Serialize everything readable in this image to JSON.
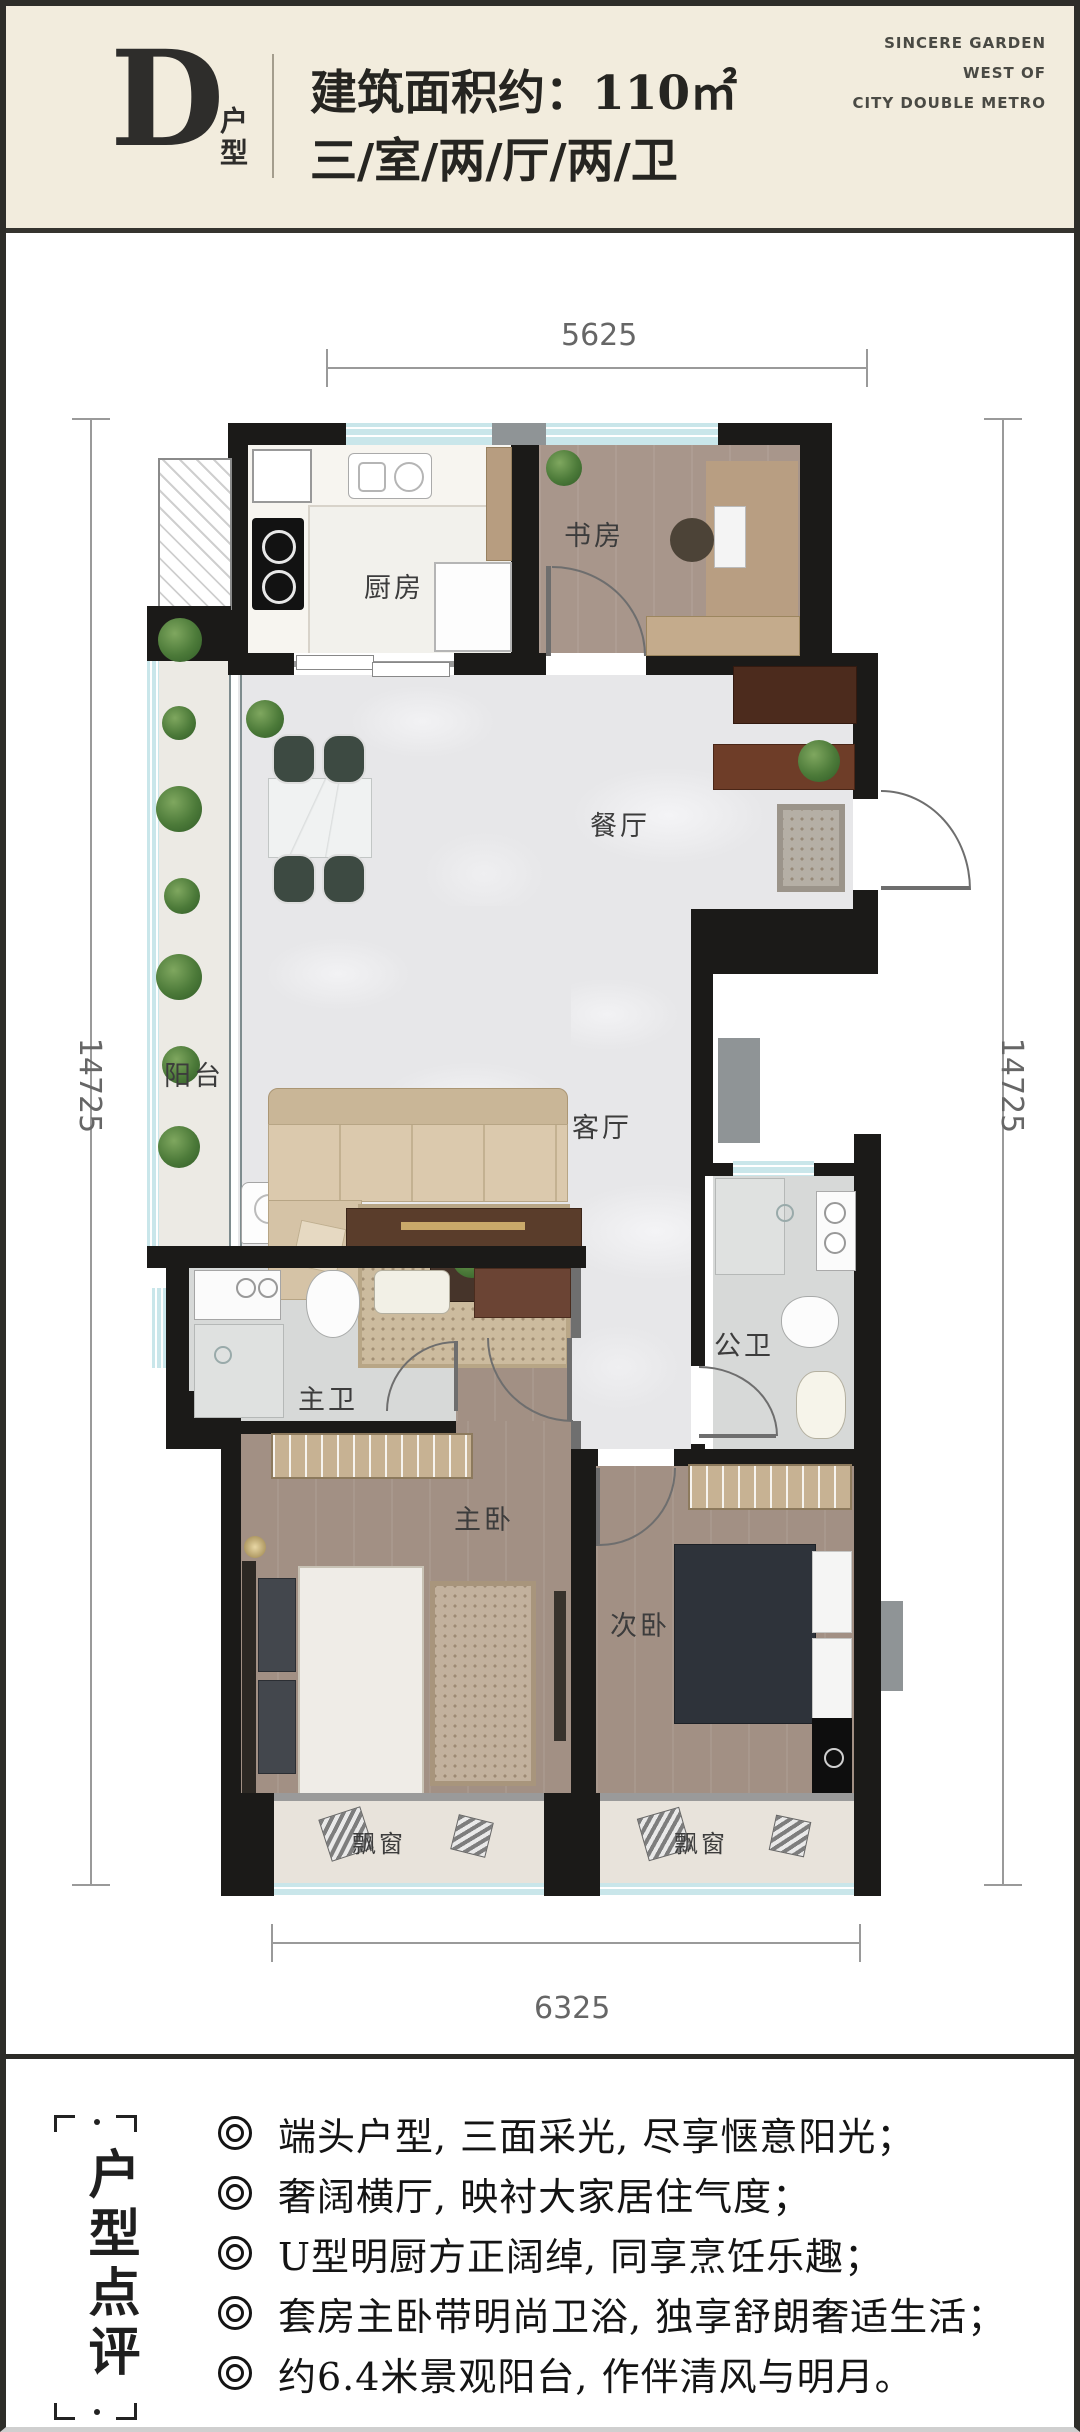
{
  "header": {
    "unit_letter": "D",
    "unit_label": "户型",
    "area_line": "建筑面积约：110㎡",
    "layout_line": "三/室/两/厅/两/卫",
    "brand_line1": "SINCERE GARDEN",
    "brand_line2": "WEST OF",
    "brand_line3": "CITY DOUBLE METRO"
  },
  "plan": {
    "dims": {
      "top": "5625",
      "left": "14725",
      "right": "14725",
      "bottom": "6325"
    },
    "rooms": {
      "kitchen": "厨房",
      "study": "书房",
      "dining": "餐厅",
      "balcony": "阳台",
      "living": "客厅",
      "master_bath": "主卫",
      "guest_bath": "公卫",
      "master_bedroom": "主卧",
      "second_bedroom": "次卧",
      "bay_window_left": "飘窗",
      "bay_window_right": "飘窗"
    }
  },
  "review": {
    "title_vertical": "户型点评",
    "bullets": [
      "端头户型, 三面采光, 尽享惬意阳光；",
      "奢阔横厅, 映衬大家居住气度；",
      "U型明厨方正阔绰, 同享烹饪乐趣；",
      "套房主卧带明尚卫浴, 独享舒朗奢适生活；",
      "约6.4米景观阳台, 作伴清风与明月。"
    ]
  },
  "colors": {
    "header_cream": "#f2ecdd",
    "wall_black": "#1b1a18",
    "window_teal": "#c9e6ea",
    "marble_floor": "#e7e7e9",
    "wood_floor": "#a8968b"
  }
}
